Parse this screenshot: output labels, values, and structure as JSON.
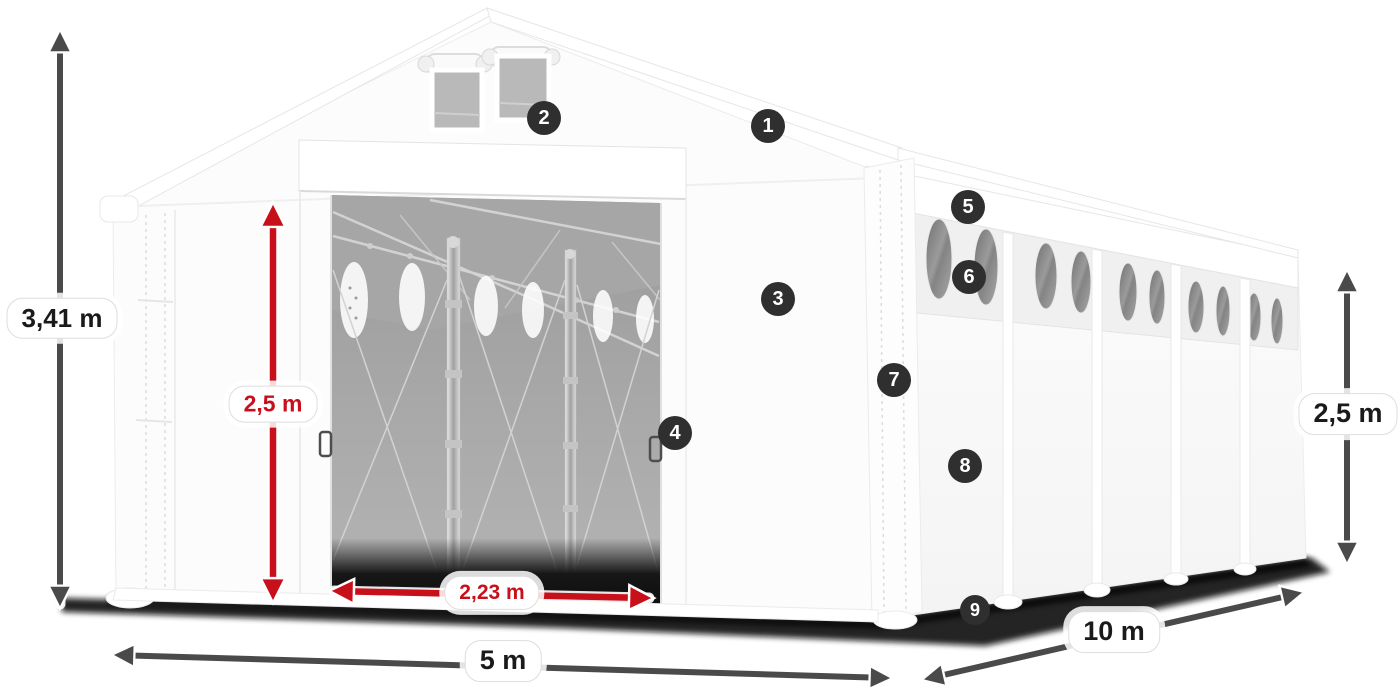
{
  "diagram": {
    "subject": "white-storage-tent-with-dimensions",
    "colors": {
      "dimension_red": "#c8101b",
      "dimension_gray": "#4a4a4a",
      "badge_background": "#2f2f2f",
      "badge_text": "#ffffff",
      "label_text": "#1a1a1a",
      "tent_white": "#fcfcfc",
      "interior_gray": "#a3a3a3"
    },
    "dimensions": {
      "total_height": {
        "label": "3,41 m"
      },
      "door_height": {
        "label": "2,5 m"
      },
      "door_width": {
        "label": "2,23 m"
      },
      "front_width": {
        "label": "5 m"
      },
      "side_length": {
        "label": "10 m"
      },
      "side_height": {
        "label": "2,5 m"
      }
    },
    "callouts": {
      "items": [
        {
          "number": "1"
        },
        {
          "number": "2"
        },
        {
          "number": "3"
        },
        {
          "number": "4"
        },
        {
          "number": "5"
        },
        {
          "number": "6"
        },
        {
          "number": "7"
        },
        {
          "number": "8"
        },
        {
          "number": "9"
        }
      ]
    }
  }
}
